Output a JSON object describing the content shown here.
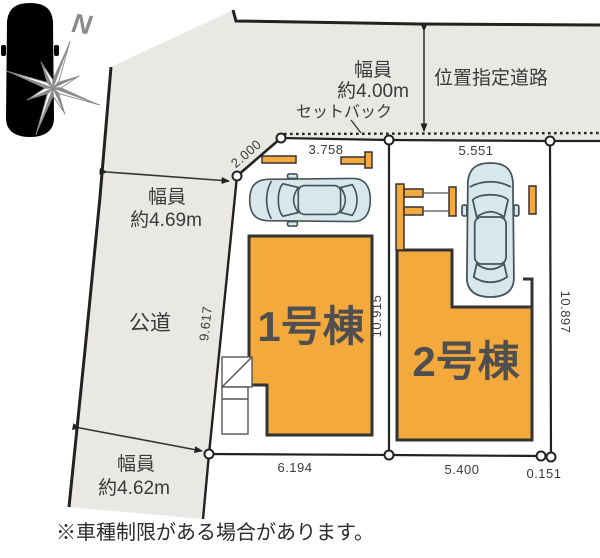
{
  "compass": {
    "north_label": "N"
  },
  "roads": {
    "top": {
      "width_line1": "幅員",
      "width_line2": "約4.00m",
      "name": "位置指定道路",
      "setback_label": "セットバック"
    },
    "left": {
      "width_line1": "幅員",
      "width_line2": "約4.69m",
      "name": "公道"
    },
    "bottom": {
      "width_line1": "幅員",
      "width_line2": "約4.62m"
    }
  },
  "buildings": [
    {
      "label": "1号棟"
    },
    {
      "label": "2号棟"
    }
  ],
  "dimensions": {
    "corner_cut": "2.000",
    "north_lot1": "3.758",
    "north_lot2": "5.551",
    "west_lot1": "9.617",
    "between_lots": "10.915",
    "east_lot2": "10.897",
    "south_lot1": "6.194",
    "south_lot2": "5.400",
    "south_sliver": "0.151"
  },
  "note": "※車種制限がある場合があります。",
  "colors": {
    "road_fill": "#e9e8e5",
    "building_fill": "#f4a93c",
    "building_border": "#333333",
    "car_fill": "#d6e8eb",
    "line": "#222222"
  }
}
